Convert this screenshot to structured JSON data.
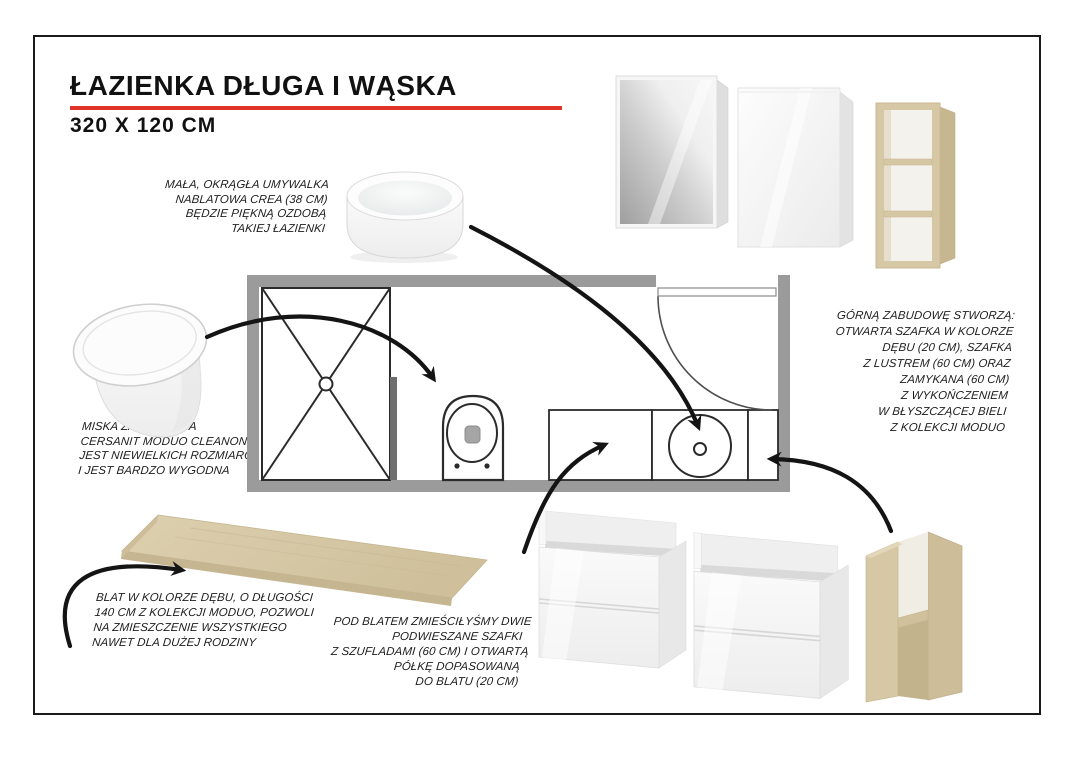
{
  "page": {
    "title": "ŁAZIENKA DŁUGA I WĄSKA",
    "subtitle": "320 X 120 CM"
  },
  "notes": {
    "washbasin": "MAŁA, OKRĄGŁA UMYWALKA\nNABLATOWA CREA (38 CM)\nBĘDZIE PIĘKNĄ OZDOBĄ\nTAKIEJ ŁAZIENKI",
    "toilet": "MISKA ZAWIESZANA\nCERSANIT MODUO CLEANON,\nJEST NIEWIELKICH ROZMIARÓW\nI JEST BARDZO WYGODNA",
    "upper_cabinets": "GÓRNĄ ZABUDOWĘ STWORZĄ:\nOTWARTA SZAFKA W KOLORZE\nDĘBU (20 CM), SZAFKA\nZ LUSTREM (60 CM) ORAZ\nZAMYKANA (60 CM)\nZ WYKOŃCZENIEM\nW BŁYSZCZĄCEJ BIELI\nZ KOLEKCJI MODUO",
    "countertop": "BLAT W KOLORZE DĘBU, O DŁUGOŚCI\n140 CM Z KOLEKCJI MODUO, POZWOLI\nNA ZMIESZCZENIE WSZYSTKIEGO\nNAWET DLA DUŻEJ RODZINY",
    "under_countertop": "POD BLATEM ZMIEŚCIŁYŚMY DWIE\nPODWIESZANE SZAFKI\nZ SZUFLADAMI (60 CM) I OTWARTĄ\nPÓŁKĘ DOPASOWANĄ\nDO BLATU (20 CM)"
  },
  "colors": {
    "accent_red": "#e0342b",
    "wall_gray": "#9b9b9b",
    "wood_oak": "#d7c8a5",
    "line_black": "#141414"
  },
  "plan": {
    "room_width_cm": "320",
    "room_depth_cm": "120",
    "fixtures": [
      "shower",
      "wall-hung toilet",
      "vanity cabinet",
      "round sink",
      "open shelf",
      "door"
    ]
  },
  "illustrations": [
    "round countertop washbasin",
    "wall-hung toilet",
    "mirror cabinet",
    "gloss white wall cabinet",
    "oak open wall shelf",
    "oak countertop",
    "drawer vanity cabinet",
    "drawer vanity cabinet",
    "oak open base cabinet"
  ]
}
